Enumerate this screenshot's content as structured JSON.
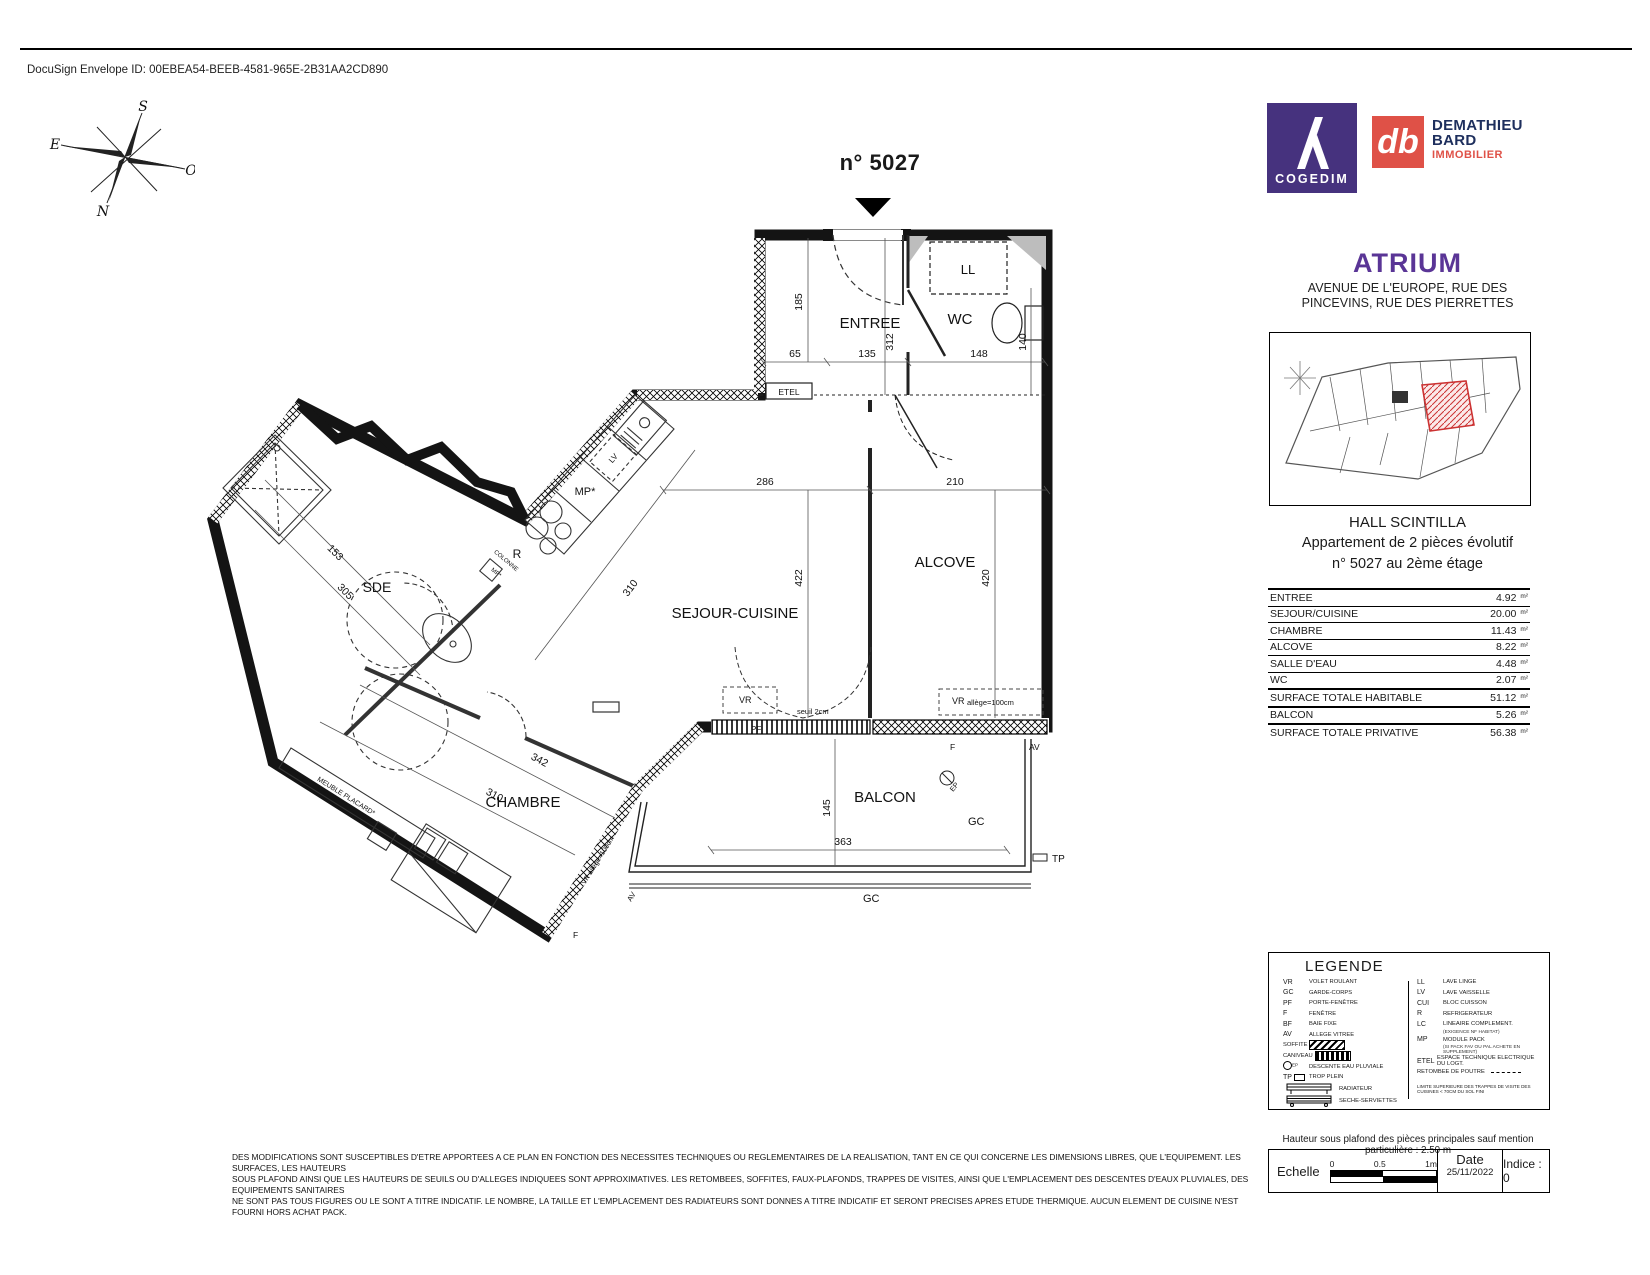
{
  "page": {
    "docusign_id": "DocuSign Envelope ID: 00EBEA54-BEEB-4581-965E-2B31AA2CD890"
  },
  "compass": {
    "n": "N",
    "s": "S",
    "e": "E",
    "o": "O"
  },
  "header": {
    "plan_number": "n° 5027"
  },
  "logos": {
    "cogedim_name": "COGEDIM",
    "db_monogram": "db",
    "db_name_1": "DEMATHIEU",
    "db_name_2": "BARD",
    "db_name_3": "IMMOBILIER"
  },
  "project": {
    "name": "ATRIUM",
    "address_1": "AVENUE DE L'EUROPE, RUE DES",
    "address_2": "PINCEVINS, RUE DES PIERRETTES",
    "hall": "HALL SCINTILLA",
    "apt_1": "Appartement de 2 pièces évolutif",
    "apt_2": "n° 5027 au 2ème étage"
  },
  "surface_table": {
    "rows": [
      {
        "label": "ENTREE",
        "value": "4.92",
        "unit": "m²"
      },
      {
        "label": "SEJOUR/CUISINE",
        "value": "20.00",
        "unit": "m²"
      },
      {
        "label": "CHAMBRE",
        "value": "11.43",
        "unit": "m²"
      },
      {
        "label": "ALCOVE",
        "value": "8.22",
        "unit": "m²"
      },
      {
        "label": "SALLE D'EAU",
        "value": "4.48",
        "unit": "m²"
      },
      {
        "label": "WC",
        "value": "2.07",
        "unit": "m²"
      },
      {
        "label": "SURFACE TOTALE HABITABLE",
        "value": "51.12",
        "unit": "m²"
      },
      {
        "label": "BALCON",
        "value": "5.26",
        "unit": "m²"
      },
      {
        "label": "SURFACE TOTALE PRIVATIVE",
        "value": "56.38",
        "unit": "m²"
      }
    ]
  },
  "plan": {
    "rooms": {
      "entree": "ENTREE",
      "wc": "WC",
      "alcove": "ALCOVE",
      "sejour": "SEJOUR-CUISINE",
      "sde": "SDE",
      "chambre": "CHAMBRE",
      "balcon": "BALCON"
    },
    "equipment": {
      "ll": "LL",
      "etel": "ETEL",
      "mp": "MP*",
      "r": "R",
      "lv": "LV",
      "colonne_1": "COLONNE",
      "colonne_2": "MP*",
      "meuble": "MEUBLE PLACARD*"
    },
    "dims": {
      "d65": "65",
      "d135": "135",
      "d148": "148",
      "d185": "185",
      "d312": "312",
      "d140": "140",
      "d286": "286",
      "d210": "210",
      "d422": "422",
      "d420": "420",
      "d310_sejour": "310",
      "d153": "153",
      "d305": "305",
      "d342": "342",
      "d310_chambre": "310",
      "d145": "145",
      "d363": "363"
    },
    "annotations": {
      "vr": "VR",
      "vr_allege": "VR",
      "allege": "allège=100cm",
      "seuil": "seuil 2cm",
      "gc": "GC",
      "gc2": "GC",
      "tp": "TP",
      "f": "F",
      "av": "AV",
      "ep": "EP",
      "pf": "PF",
      "vr_allege_chambre": "VR allège=100cm"
    }
  },
  "legend": {
    "title": "LEGENDE",
    "left": [
      {
        "abbr": "VR",
        "label": "VOLET ROULANT"
      },
      {
        "abbr": "GC",
        "label": "GARDE-CORPS"
      },
      {
        "abbr": "PF",
        "label": "PORTE-FENÊTRE"
      },
      {
        "abbr": "F",
        "label": "FENÊTRE"
      },
      {
        "abbr": "BF",
        "label": "BAIE FIXE"
      },
      {
        "abbr": "AV",
        "label": "ALLEGE VITREE"
      },
      {
        "abbr": "SOFFITE",
        "label": ""
      },
      {
        "abbr": "CANIVEAU",
        "label": ""
      },
      {
        "abbr": "EP",
        "label": "DESCENTE EAU PLUVIALE"
      },
      {
        "abbr": "TP",
        "label": "TROP PLEIN"
      },
      {
        "abbr": "",
        "label": "RADIATEUR"
      },
      {
        "abbr": "",
        "label": "SECHE-SERVIETTES"
      }
    ],
    "right": [
      {
        "abbr": "LL",
        "label": "LAVE LINGE",
        "sub": ""
      },
      {
        "abbr": "LV",
        "label": "LAVE VAISSELLE",
        "sub": ""
      },
      {
        "abbr": "CUI",
        "label": "BLOC CUISSON",
        "sub": ""
      },
      {
        "abbr": "R",
        "label": "REFRIGERATEUR",
        "sub": ""
      },
      {
        "abbr": "LC",
        "label": "LINEAIRE COMPLEMENT.",
        "sub": "(EXIGENCE NF HABITAT)"
      },
      {
        "abbr": "MP",
        "label": "MODULE PACK",
        "sub": "(SI PACK FAV OU PAL ACHETE EN SUPPLEMENT)"
      },
      {
        "abbr": "ETEL",
        "label": "ESPACE TECHNIQUE ELECTRIQUE DU LOGT.",
        "sub": ""
      },
      {
        "abbr": "",
        "label": "RETOMBEE DE POUTRE",
        "sub": ""
      }
    ],
    "note": "LIMITE SUPERIEURE DES TRAPPES DE VISITE DES CUISINES < 70CM DU SOL FINI"
  },
  "footer": {
    "disclaimer_1": "DES MODIFICATIONS SONT SUSCEPTIBLES D'ETRE APPORTEES A CE PLAN EN FONCTION DES NECESSITES TECHNIQUES OU REGLEMENTAIRES DE LA REALISATION, TANT EN CE QUI CONCERNE LES DIMENSIONS LIBRES, QUE L'EQUIPEMENT. LES SURFACES, LES HAUTEURS",
    "disclaimer_2": "SOUS PLAFOND AINSI QUE LES HAUTEURS DE SEUILS OU D'ALLEGES INDIQUEES SONT APPROXIMATIVES. LES RETOMBEES, SOFFITES, FAUX-PLAFONDS, TRAPPES DE VISITES, AINSI QUE L'EMPLACEMENT DES DESCENTES D'EAUX PLUVIALES, DES EQUIPEMENTS SANITAIRES",
    "disclaimer_3": "NE SONT PAS TOUS FIGURES OU LE SONT A TITRE INDICATIF. LE NOMBRE, LA TAILLE ET L'EMPLACEMENT DES RADIATEURS SONT DONNES A TITRE INDICATIF ET SERONT PRECISES APRES ETUDE THERMIQUE. AUCUN ELEMENT DE CUISINE N'EST FOURNI HORS ACHAT PACK.",
    "ceiling_note": "Hauteur sous plafond des pièces principales sauf mention particulière : 2.50 m",
    "echelle_label": "Echelle",
    "scale_0": "0",
    "scale_05": "0.5",
    "scale_1": "1m",
    "date_label": "Date",
    "date_value": "25/11/2022",
    "indice": "Indice : 0"
  },
  "colors": {
    "cogedim_purple": "#46327e",
    "atrium_purple": "#5a3596",
    "db_red": "#df5147",
    "db_navy": "#1e2f5d",
    "unit_highlight_red": "#cc3333"
  }
}
